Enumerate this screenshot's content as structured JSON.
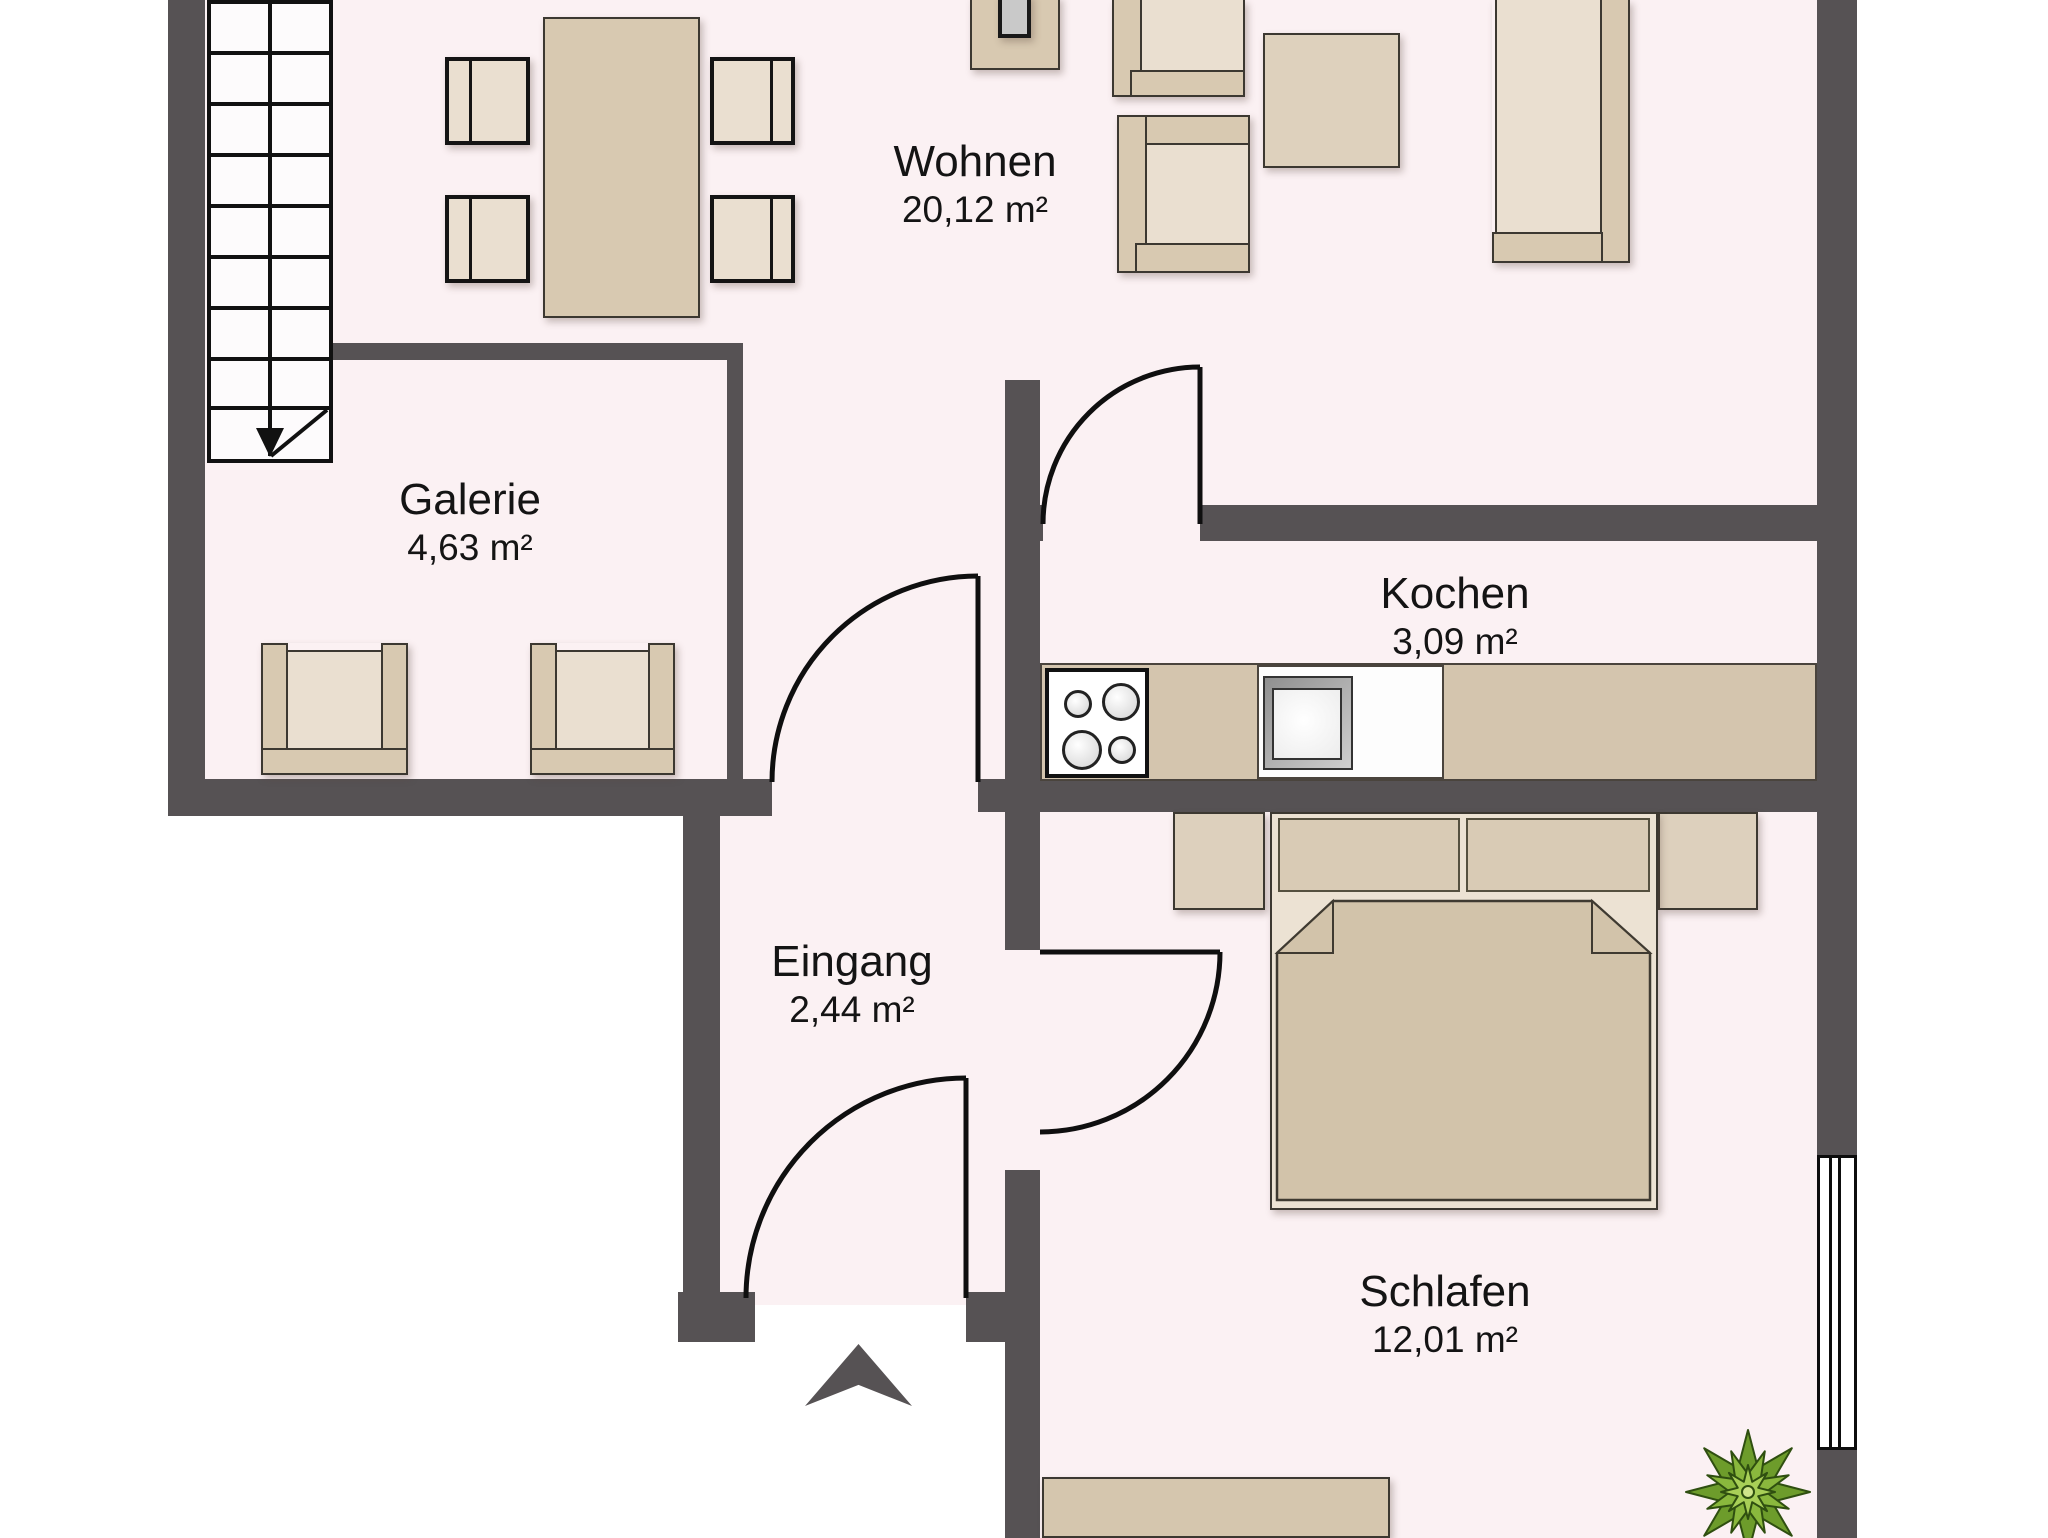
{
  "floorplan": {
    "type": "apartment-floor-plan",
    "rooms": {
      "wohnen": {
        "name": "Wohnen",
        "area": "20,12 m²"
      },
      "galerie": {
        "name": "Galerie",
        "area": "4,63 m²"
      },
      "kochen": {
        "name": "Kochen",
        "area": "3,09 m²"
      },
      "eingang": {
        "name": "Eingang",
        "area": "2,44 m²"
      },
      "schlafen": {
        "name": "Schlafen",
        "area": "12,01 m²"
      }
    },
    "icons": {
      "stairs": "staircase-down-arrow-icon",
      "entrance": "entrance-up-arrow-icon",
      "window": "window-icon",
      "plant": "plant-icon",
      "stove": "stove-4-burners-icon",
      "sink": "kitchen-sink-icon"
    },
    "colors": {
      "wall": "#565254",
      "floor": "#fbf1f3",
      "outline": "#3c3831",
      "tan": "#d8c9b1",
      "tan_light": "#eadfd0",
      "tan_mid": "#ddd0bd",
      "plant_green": "#7fb136",
      "ink": "#141414"
    }
  }
}
